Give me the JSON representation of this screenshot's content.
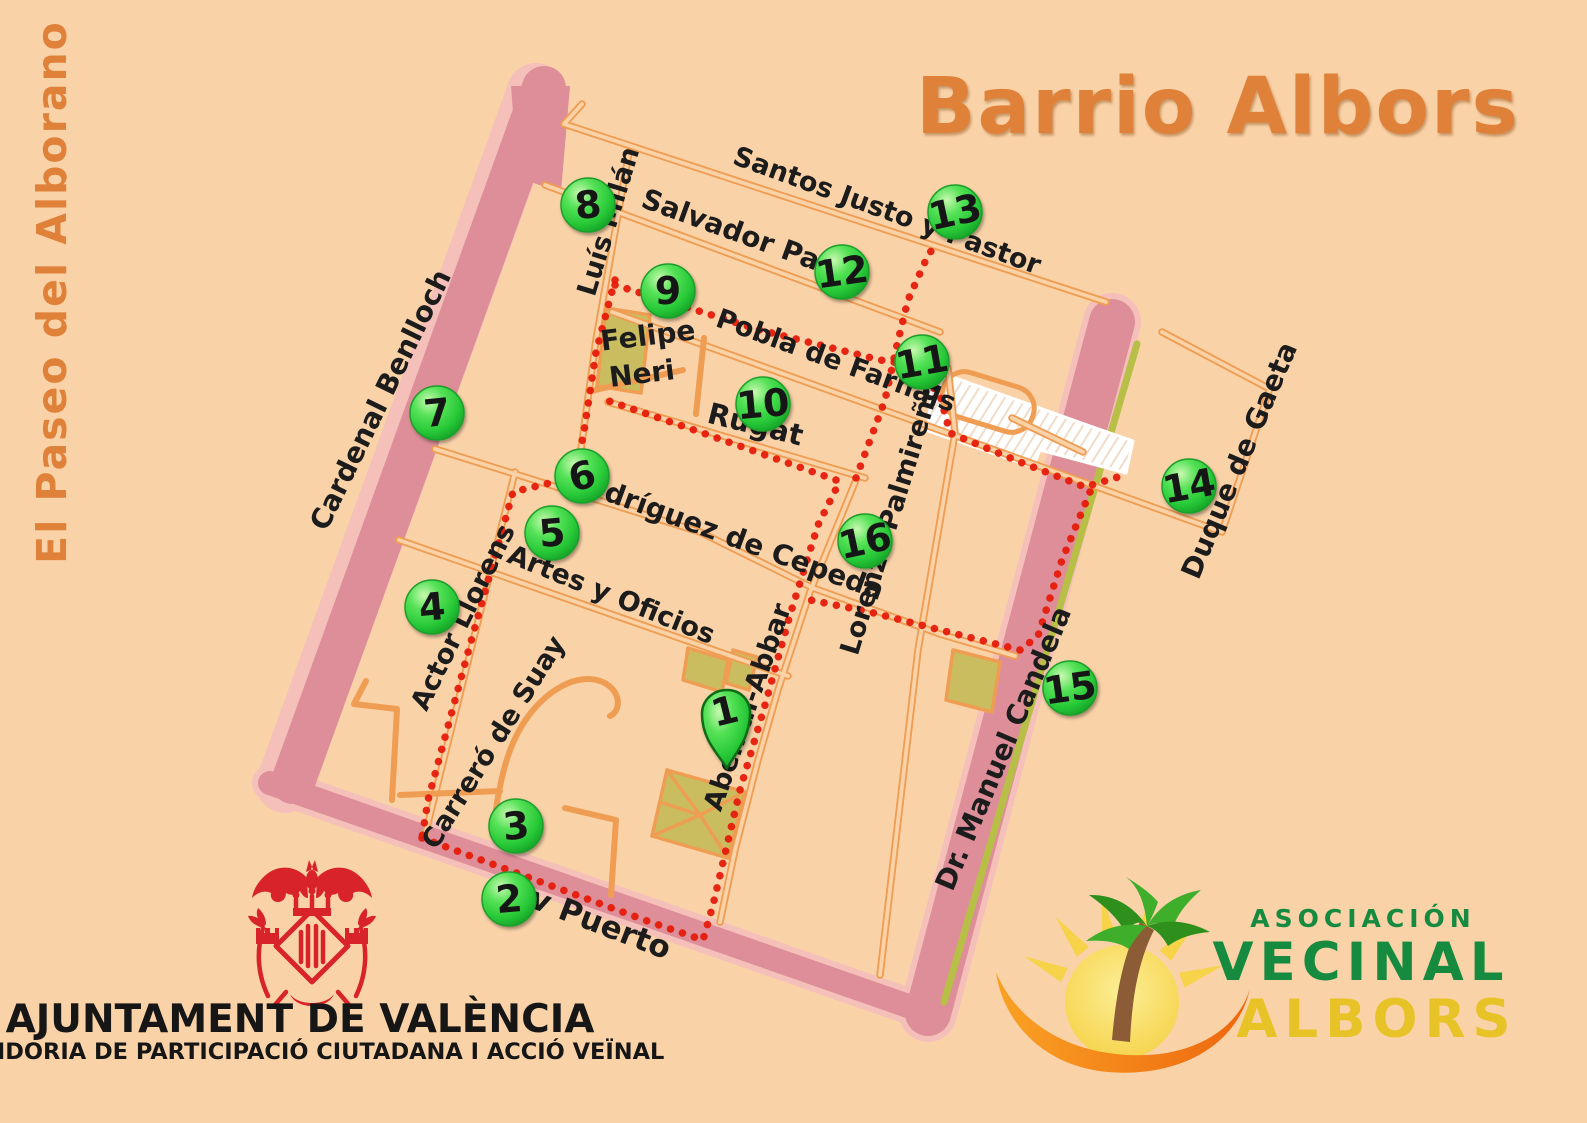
{
  "title": "Barrio Albors",
  "side_label": "El Paseo del Alborano",
  "map": {
    "streets": {
      "santos_justo_y_pastor": "Santos Justo y Pastor",
      "salvador_pau": "Salvador Pau",
      "luis_milan": "Luís Milán",
      "felipe_neri": {
        "line1": "Felipe",
        "line2": "Neri"
      },
      "pobla_de_farnals": "Pobla de Farnals",
      "rugat": "Rugat",
      "cardenal_benlloch": "Cardenal Benlloch",
      "rodriguez_de_cepeda": "Rodríguez de Cepeda",
      "artes_y_oficios": "Artes y Oficios",
      "actor_llorens": "Actor Llorens",
      "carrero_de_suay": "Carreró de Suay",
      "aben_al_abbar": "Aben al-Abbar",
      "lorenzo_palmireno": "Lorenzo Palmireño",
      "duque_de_gaeta": "Duque de Gaeta",
      "dr_manuel_candela": "Dr. Manuel Candela",
      "av_puerto": "Av Puerto"
    },
    "markers": {
      "m1": "1",
      "m2": "2",
      "m3": "3",
      "m4": "4",
      "m5": "5",
      "m6": "6",
      "m7": "7",
      "m8": "8",
      "m9": "9",
      "m10": "10",
      "m11": "11",
      "m12": "12",
      "m13": "13",
      "m14": "14",
      "m15": "15",
      "m16": "16"
    }
  },
  "footer": {
    "ajuntament": {
      "title": "AJUNTAMENT DE VALÈNCIA",
      "subtitle": "REGIDORIA DE PARTICIPACIÓ CIUTADANA I ACCIÓ VEÏNAL"
    },
    "asociacion": {
      "line1": "ASOCIACIÓN",
      "line2": "VECINAL",
      "line3": "ALBORS"
    }
  },
  "colors": {
    "background": "#fad2a8",
    "street_orange": "#ee9d52",
    "road_pink": "#dd8e98",
    "sidewalk_pink": "#f4c0b9",
    "route_red": "#e51b0b",
    "marker_green": "#2ec43a",
    "park_olive": "#cabd5f",
    "title_orange": "#df8138",
    "logo_green": "#168a3e",
    "logo_gold": "#e7c327",
    "crest_red": "#d8232a"
  }
}
